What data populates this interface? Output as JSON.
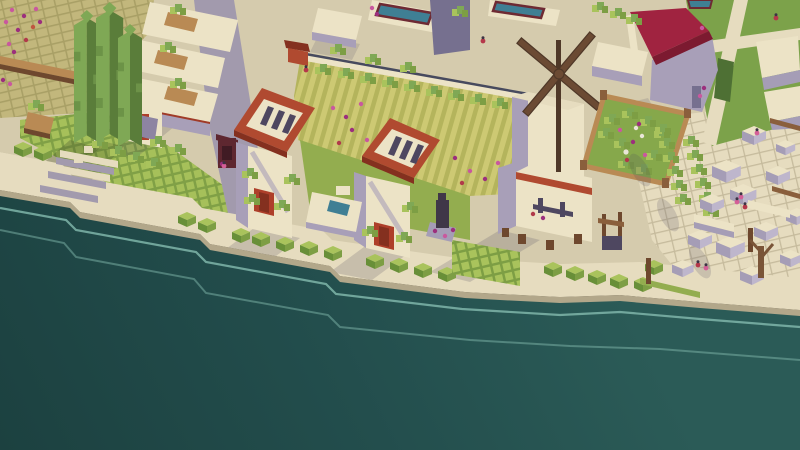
{
  "scene": {
    "type": "isometric-voxel-city-builder-screenshot",
    "setting": "coastal town waterfront, no HUD or text visible",
    "objects": [
      {
        "name": "sea"
      },
      {
        "name": "stone-quay"
      },
      {
        "name": "quay-stairs"
      },
      {
        "name": "cobblestone-terrace"
      },
      {
        "name": "flower-beds"
      },
      {
        "name": "cypress-trees"
      },
      {
        "name": "terraced-houses"
      },
      {
        "name": "gate-tower-left"
      },
      {
        "name": "gate-tower-right"
      },
      {
        "name": "courtyard-pool"
      },
      {
        "name": "statue"
      },
      {
        "name": "crop-field"
      },
      {
        "name": "windmill"
      },
      {
        "name": "walled-garden"
      },
      {
        "name": "red-roof-villa"
      },
      {
        "name": "market-ruins"
      },
      {
        "name": "well"
      },
      {
        "name": "market-stall"
      },
      {
        "name": "villagers"
      },
      {
        "name": "lawn-paths"
      },
      {
        "name": "rooftop-pools"
      }
    ]
  },
  "palette": {
    "water_deep": "#1c4140",
    "water_mid": "#234e4d",
    "water_near": "#2b5b57",
    "wave_line": "#7fb5a9",
    "pavement": "#d5cbad",
    "pavement_light": "#e6dcbf",
    "pavement_line": "#c6bb9d",
    "quay_wall": "#b2a78a",
    "cobble": "#c2b77c",
    "cobble_line": "#a9a066",
    "field_light": "#cdc973",
    "field_dark": "#b4b45c",
    "grass": "#93ad4f",
    "lawn": "#7ca24a",
    "grass_dark": "#6b8a3c",
    "hedge_light": "#a9c35c",
    "hedge_dark": "#7d9e44",
    "hedge_side": "#688f38",
    "hedge_deep": "#4e7034",
    "tree_light": "#7fa855",
    "tree_dark": "#5a7d3a",
    "trunk": "#7a5538",
    "roof_red": "#b04a30",
    "roof_red_dark": "#84301f",
    "door_red": "#ae3f2a",
    "accent_red": "#a03b28",
    "roof_crimson": "#a02340",
    "roof_crimson_dark": "#7c1a30",
    "wall_shadow": "#a89fb8",
    "wall_shadow_deep": "#8d84a2",
    "wall_dark": "#76708f",
    "road": "#a29aad",
    "shadow": "#4a4460",
    "shadow_olive": "#47552c",
    "slot_dark": "#4e4760",
    "statue_dark": "#403748",
    "wood": "#b98a54",
    "wood_dark": "#8a5f3c",
    "beam_dark": "#6e482e",
    "blade": "#6b4a33",
    "blade_dark": "#4f3828",
    "pool_blue": "#3f7f94",
    "pool_rim": "#6e2a33",
    "cream_block": "#ece3c6",
    "block_side": "#a59db6",
    "block_side2": "#beb6cc",
    "flower_pink": "#c9589e",
    "flower_magenta": "#9c2f7d",
    "flower_red": "#b13a4a",
    "flower_orange": "#c05540",
    "people_pink": "#d45f97",
    "people_red": "#b5384a",
    "head_dark": "#3c3344",
    "goose_white": "#eae6d8",
    "coping_dark": "#474a5e",
    "stall_maroon": "#5e2730",
    "stall_dark": "#401b24"
  },
  "people": [
    {
      "x": 306,
      "y": 70,
      "c": "people_red"
    },
    {
      "x": 483,
      "y": 41,
      "c": "people_red"
    },
    {
      "x": 737,
      "y": 202,
      "c": "people_pink"
    },
    {
      "x": 745,
      "y": 207,
      "c": "people_red"
    },
    {
      "x": 741,
      "y": 197,
      "c": "people_pink"
    },
    {
      "x": 698,
      "y": 265,
      "c": "people_red"
    },
    {
      "x": 706,
      "y": 268,
      "c": "people_pink"
    },
    {
      "x": 757,
      "y": 133,
      "c": "people_pink"
    },
    {
      "x": 776,
      "y": 18,
      "c": "people_red"
    },
    {
      "x": 224,
      "y": 166,
      "c": "people_pink"
    }
  ],
  "flowers": [
    {
      "x": 12,
      "y": 10,
      "c": "flower_pink"
    },
    {
      "x": 24,
      "y": 16,
      "c": "flower_magenta"
    },
    {
      "x": 36,
      "y": 9,
      "c": "flower_pink"
    },
    {
      "x": 18,
      "y": 30,
      "c": "flower_magenta"
    },
    {
      "x": 33,
      "y": 27,
      "c": "flower_orange"
    },
    {
      "x": 9,
      "y": 44,
      "c": "flower_pink"
    },
    {
      "x": 26,
      "y": 40,
      "c": "flower_red"
    },
    {
      "x": 40,
      "y": 22,
      "c": "flower_magenta"
    },
    {
      "x": 6,
      "y": 22,
      "c": "flower_pink"
    },
    {
      "x": 14,
      "y": 52,
      "c": "flower_magenta"
    },
    {
      "x": 3,
      "y": 80,
      "c": "flower_magenta"
    },
    {
      "x": 10,
      "y": 84,
      "c": "flower_pink"
    },
    {
      "x": 333,
      "y": 108,
      "c": "flower_pink"
    },
    {
      "x": 346,
      "y": 117,
      "c": "flower_magenta"
    },
    {
      "x": 361,
      "y": 104,
      "c": "flower_pink"
    },
    {
      "x": 352,
      "y": 130,
      "c": "flower_magenta"
    },
    {
      "x": 367,
      "y": 140,
      "c": "flower_pink"
    },
    {
      "x": 339,
      "y": 143,
      "c": "flower_red"
    },
    {
      "x": 372,
      "y": 8,
      "c": "flower_pink"
    },
    {
      "x": 377,
      "y": 14,
      "c": "flower_magenta"
    },
    {
      "x": 455,
      "y": 158,
      "c": "flower_magenta"
    },
    {
      "x": 470,
      "y": 171,
      "c": "flower_pink"
    },
    {
      "x": 485,
      "y": 179,
      "c": "flower_magenta"
    },
    {
      "x": 498,
      "y": 163,
      "c": "flower_pink"
    },
    {
      "x": 462,
      "y": 183,
      "c": "flower_red"
    },
    {
      "x": 533,
      "y": 214,
      "c": "flower_red"
    },
    {
      "x": 543,
      "y": 218,
      "c": "flower_magenta"
    },
    {
      "x": 435,
      "y": 231,
      "c": "flower_magenta"
    },
    {
      "x": 445,
      "y": 236,
      "c": "flower_pink"
    },
    {
      "x": 453,
      "y": 230,
      "c": "flower_magenta"
    },
    {
      "x": 620,
      "y": 130,
      "c": "flower_pink"
    },
    {
      "x": 633,
      "y": 142,
      "c": "flower_magenta"
    },
    {
      "x": 645,
      "y": 155,
      "c": "flower_pink"
    },
    {
      "x": 627,
      "y": 160,
      "c": "flower_red"
    },
    {
      "x": 639,
      "y": 124,
      "c": "flower_magenta"
    },
    {
      "x": 636,
      "y": 128,
      "c": "goose_white"
    },
    {
      "x": 642,
      "y": 136,
      "c": "goose_white"
    },
    {
      "x": 626,
      "y": 152,
      "c": "goose_white",
      "r": 2.6
    },
    {
      "x": 702,
      "y": 28,
      "c": "flower_pink"
    },
    {
      "x": 704,
      "y": 88,
      "c": "flower_magenta"
    },
    {
      "x": 700,
      "y": 96,
      "c": "flower_pink"
    },
    {
      "x": 222,
      "y": 164,
      "c": "flower_magenta"
    }
  ]
}
